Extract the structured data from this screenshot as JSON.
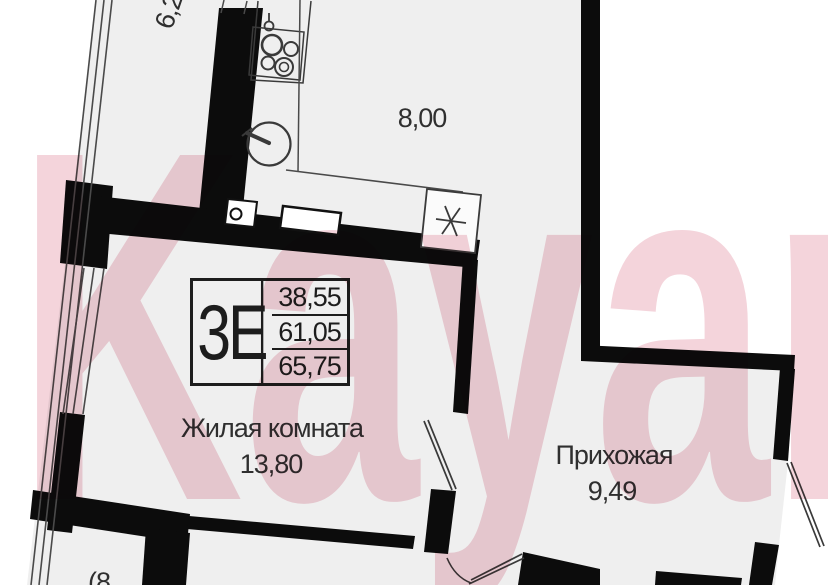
{
  "watermark": {
    "text": "Kayan"
  },
  "unit_card": {
    "type_label": "3Е",
    "rows": [
      {
        "value": "38,55"
      },
      {
        "value": "61,05"
      },
      {
        "value": "65,75"
      }
    ]
  },
  "labels": {
    "loggia_area_partial": "6,2",
    "kitchen_area": "8,00",
    "living_room_name": "Жилая комната",
    "living_room_area": "13,80",
    "hallway_name": "Прихожая",
    "hallway_area": "9,49",
    "bottom_room_area_partial": "(8"
  },
  "colors": {
    "floor": "#efefef",
    "wall": "#0c0c0c",
    "watermark_pink": "#f4d4db",
    "label_text": "#2f2f2f"
  }
}
